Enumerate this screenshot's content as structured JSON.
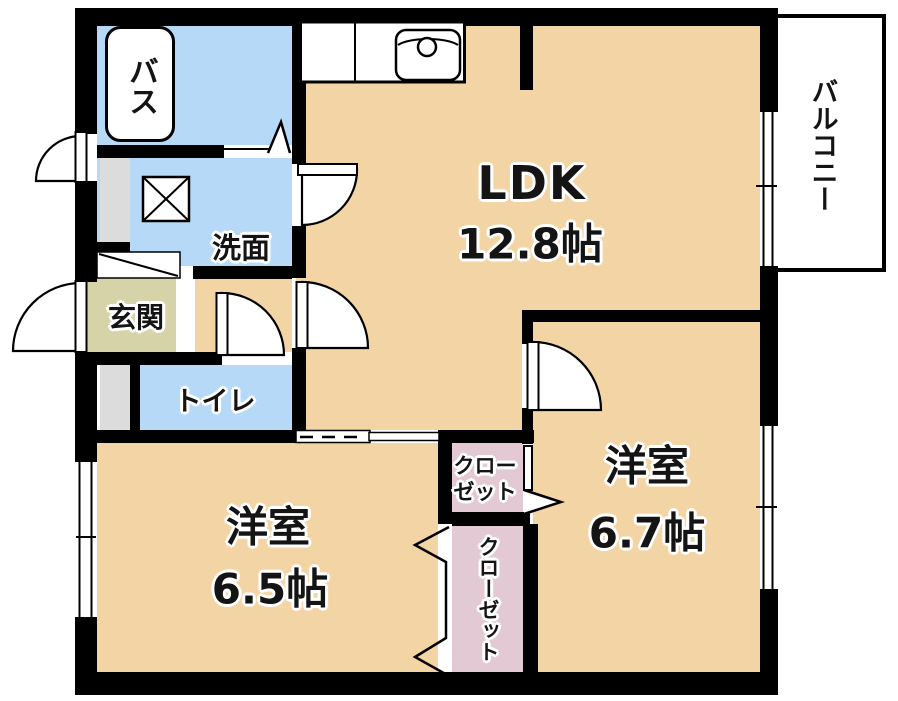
{
  "rooms": {
    "bath": {
      "label": "バス"
    },
    "washroom": {
      "label": "洗面"
    },
    "entrance": {
      "label": "玄関"
    },
    "toilet": {
      "label": "トイレ"
    },
    "ldk": {
      "label": "LDK",
      "size": "12.8帖"
    },
    "balcony": {
      "label": "バルコニー"
    },
    "western_room_right": {
      "label": "洋室",
      "size": "6.7帖"
    },
    "western_room_left": {
      "label": "洋室",
      "size": "6.5帖"
    },
    "closet_upper": {
      "label_line1": "クロー",
      "label_line2": "ゼット"
    },
    "closet_lower": {
      "label": "クローゼット"
    }
  },
  "colors": {
    "background": "#ffffff",
    "wall": "#000000",
    "room_floor": "#f3d4a4",
    "wet_area": "#b5d9f6",
    "entrance_floor": "#d7d3a9",
    "closet": "#e2c9d3",
    "fixture_gray": "#dcdcdc"
  }
}
